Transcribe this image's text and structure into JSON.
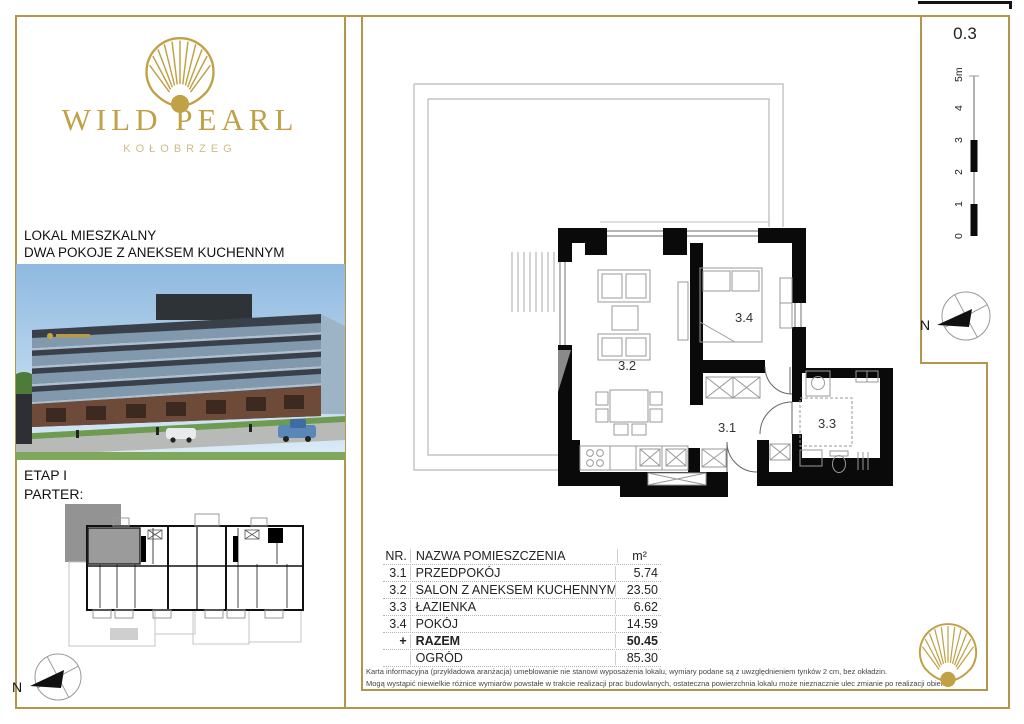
{
  "brand": {
    "name": "WILD PEARL",
    "city": "KOŁOBRZEG"
  },
  "listing": {
    "type_line1": "LOKAL MIESZKALNY",
    "type_line2": "DWA POKOJE Z ANEKSEM KUCHENNYM",
    "stage": "ETAP I",
    "floor": "PARTER:",
    "unit_number": "0.3"
  },
  "plan": {
    "room_labels": [
      "3.2",
      "3.4",
      "3.1",
      "3.3"
    ]
  },
  "scale": {
    "labels": [
      "0",
      "1",
      "2",
      "3",
      "4",
      "5m"
    ]
  },
  "compass": {
    "north": "N"
  },
  "table": {
    "headers": {
      "nr": "NR.",
      "name": "NAZWA POMIESZCZENIA",
      "area": "m²"
    },
    "rows": [
      {
        "nr": "3.1",
        "name": "PRZEDPOKÓJ",
        "area": "5.74"
      },
      {
        "nr": "3.2",
        "name": "SALON Z ANEKSEM KUCHENNYM",
        "area": "23.50"
      },
      {
        "nr": "3.3",
        "name": "ŁAZIENKA",
        "area": "6.62"
      },
      {
        "nr": "3.4",
        "name": "POKÓJ",
        "area": "14.59"
      },
      {
        "nr": "+",
        "name": "RAZEM",
        "area": "50.45"
      },
      {
        "nr": "",
        "name": "OGRÓD",
        "area": "85.30"
      }
    ]
  },
  "disclaimer": {
    "line1": "Karta informacyjna (przykładowa aranżacja) umeblowanie nie stanowi wyposażenia lokalu, wymiary podane są z uwzględnieniem tynków 2 cm, bez okładzin.",
    "line2": "Mogą wystąpić niewielkie różnice wymiarów powstałe w trakcie realizacji prac budowlanych, ostateczna powierzchnia lokalu może nieznacznie ulec zmianie po realizacji obiektu."
  },
  "colors": {
    "gold": "#b2974b",
    "logo_gold": "#c0a146",
    "wall_black": "#0a0a0a"
  }
}
